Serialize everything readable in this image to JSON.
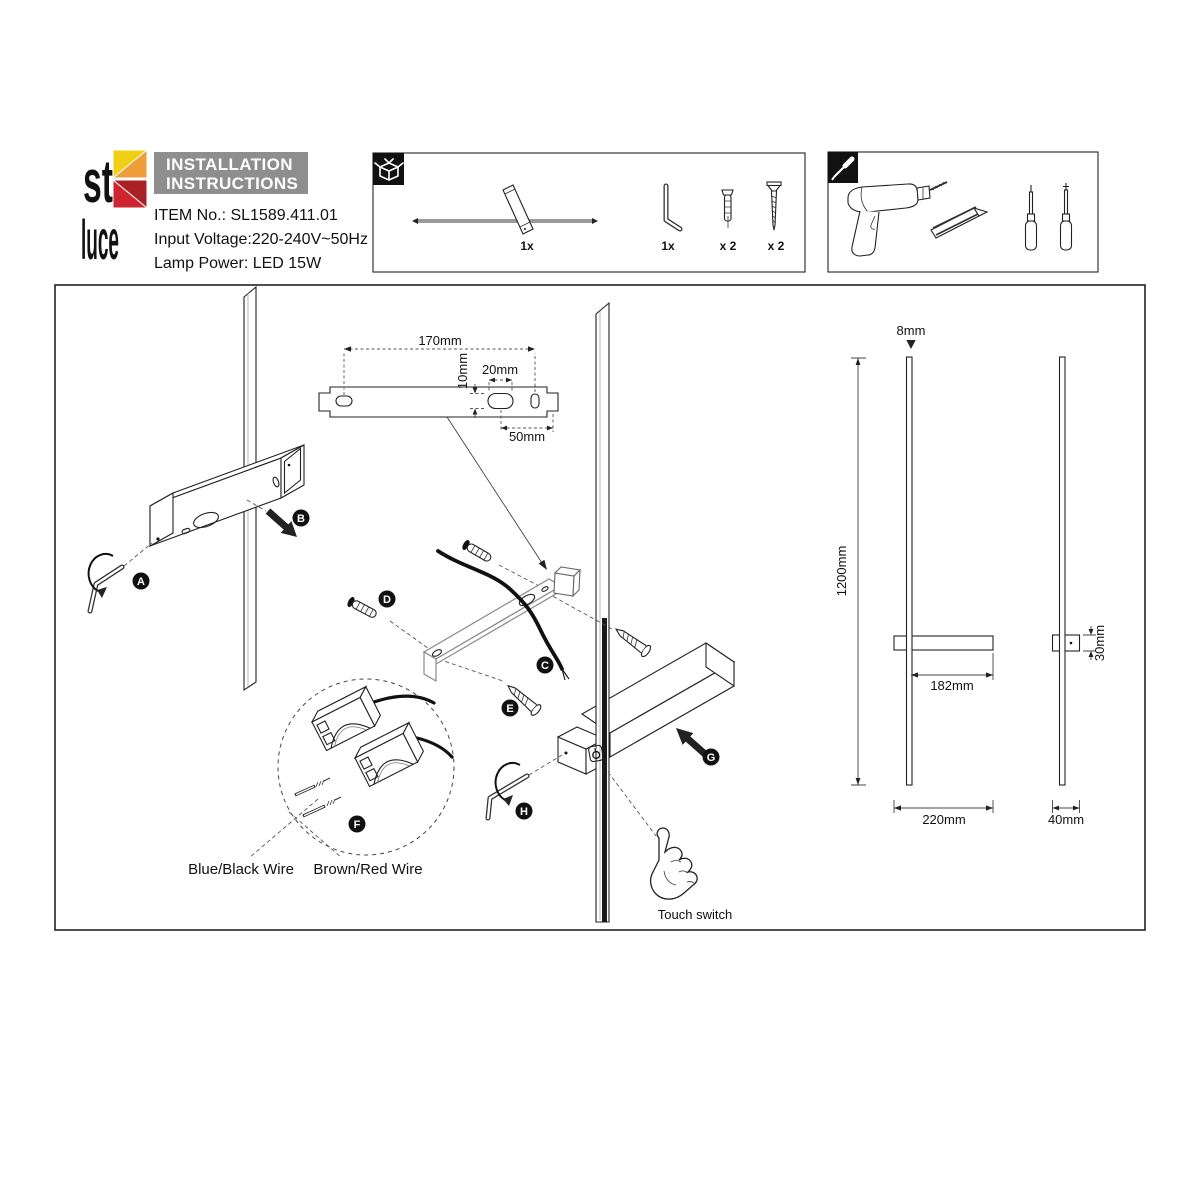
{
  "logo": {
    "word_top": "st",
    "word_bottom": "luce"
  },
  "header": {
    "title_line1": "INSTALLATION",
    "title_line2": "INSTRUCTIONS",
    "item_no": "ITEM No.: SL1589.411.01",
    "input_voltage": "Input Voltage:220-240V~50Hz",
    "lamp_power": "Lamp Power: LED 15W"
  },
  "package_box": {
    "lamp_qty": "1x",
    "hex_key_qty": "1x",
    "anchor_qty": "x 2",
    "screw_qty": "x 2"
  },
  "bracket_dims": {
    "length": "170mm",
    "slot_height": "10mm",
    "slot_width": "20mm",
    "end_offset": "50mm"
  },
  "steps": {
    "a": "A",
    "b": "B",
    "c": "C",
    "d": "D",
    "e": "E",
    "f": "F",
    "g": "G",
    "h": "H"
  },
  "wiring": {
    "blue_black": "Blue/Black Wire",
    "brown_red": "Brown/Red Wire",
    "touch_switch": "Touch switch"
  },
  "dimensions": {
    "rod_diameter": "8mm",
    "total_height": "1200mm",
    "arm_length": "182mm",
    "body_depth": "30mm",
    "base_width": "220mm",
    "side_width": "40mm"
  },
  "colors": {
    "header_bg": "#8e8e8e",
    "logo_yellow": "#f2cf17",
    "logo_orange": "#ee9d3a",
    "logo_red": "#cd2630",
    "logo_dark_red": "#a92125"
  }
}
